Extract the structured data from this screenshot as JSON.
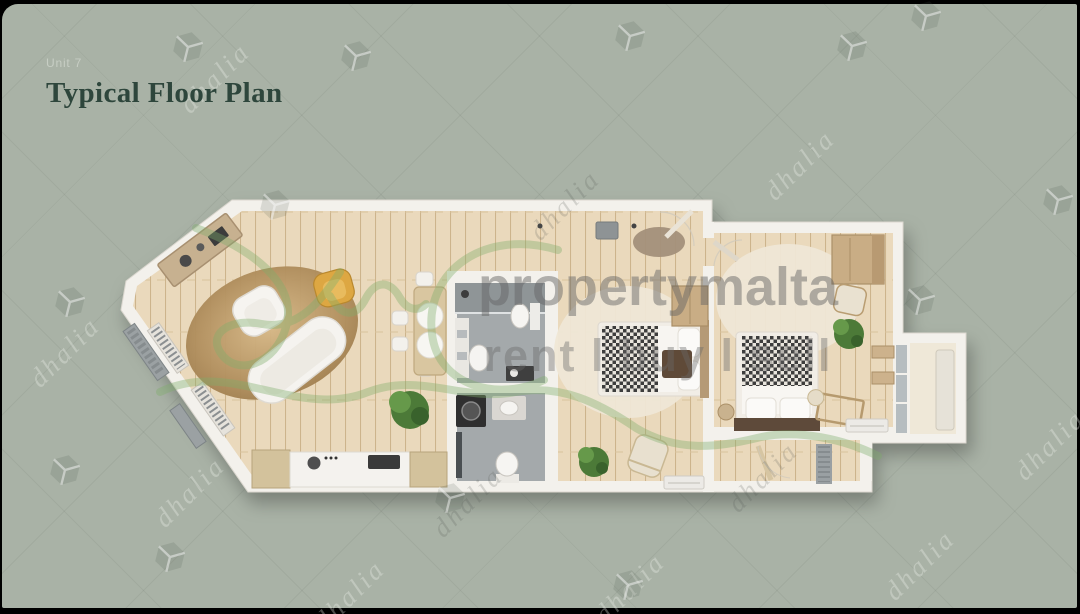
{
  "slide": {
    "unit_label": "Unit 7",
    "title": "Typical Floor Plan"
  },
  "watermarks": {
    "brand": "propertymalta",
    "tagline": "rent l buy l sell",
    "agency": "dhalia"
  },
  "colors": {
    "background": "#a9b2a6",
    "title": "#2e463c",
    "unit_label": "#c7cec4",
    "wall": "#f3f1ec",
    "wood_floor": "#ead9bc",
    "tile_floor": "#a4a9ab",
    "balcony_floor": "#efe8d8",
    "rug_jute": "#b2905f",
    "rug_cream": "#efe7d6",
    "accent_chair": "#dda742",
    "wardrobe_wood": "#c9ad85",
    "plant_green": "#4c7a38",
    "squiggle": "#7fae6b",
    "watermark_gray": "#696969"
  }
}
